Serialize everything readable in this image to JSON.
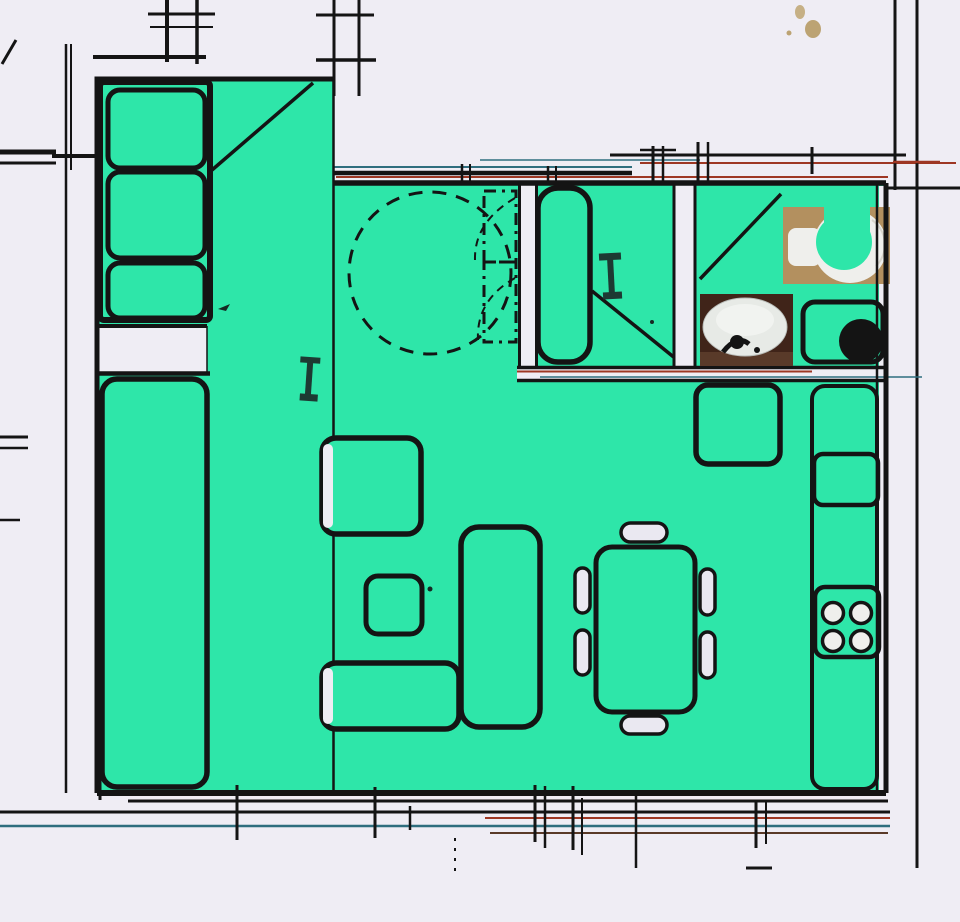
{
  "document": {
    "kind": "scanned apartment floor plan",
    "highlight_note": "apartment interior flood-filled in teal over a black-line architectural scan"
  },
  "colors": {
    "paper": "#efedf4",
    "floor": "#2ee6a9",
    "ink": "#141414",
    "accent_red": "#9e3723",
    "accent_blue": "#2f6e7e",
    "line_brown": "#5a3a28",
    "photo_tan": "#b3905f",
    "photo_brown": "#402419",
    "fixture_white": "#efefec",
    "chair_fill": "#eae8f1",
    "marker_dark": "#1d3a33",
    "smudge": "#b79c66"
  },
  "fixtures": {
    "wardrobe_sections": 3,
    "dining_chairs": 6,
    "stove_burners": 4,
    "bathroom_photos": 2
  }
}
